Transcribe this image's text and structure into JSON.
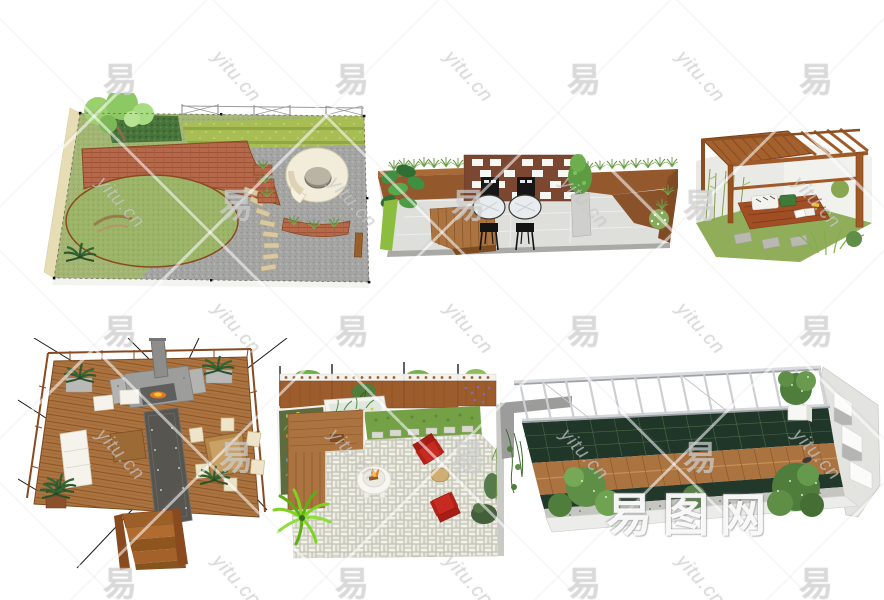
{
  "canvas": {
    "width": 884,
    "height": 600,
    "background": "#ffffff"
  },
  "watermark": {
    "glyph": "易",
    "script": "yitu.cn",
    "brand": "易图网",
    "glyph_grid": {
      "x_start": 120,
      "x_step": 116,
      "y_start": 77,
      "y_step": 126,
      "cols": 8,
      "rows": 5
    }
  },
  "renders": [
    {
      "id": "garden-plan-spiral-pavilion",
      "name": "garden plan with round lawn, terracotta paving and white spiral seat"
    },
    {
      "id": "linear-patio-brick-screen",
      "name": "long patio with brick screen wall, two black bistro chairs and glass tables"
    },
    {
      "id": "timber-pergola-daybed",
      "name": "wooden pergola over a slatted daybed with cushions and stepping stones"
    },
    {
      "id": "timber-deck-fireplace",
      "name": "large timber deck with stone fireplace, white lounge set and dining table"
    },
    {
      "id": "paver-courtyard-fire-table",
      "name": "basketweave paver courtyard with fire table, two red chairs and lattice fence"
    },
    {
      "id": "rooftop-terrace-steel-pergola",
      "name": "long rooftop terrace with steel pergola, green trellis band and wood boardwalk"
    }
  ],
  "palette": {
    "wood": "#aa7340",
    "wood_dark": "#8a5426",
    "terracotta": "#b5684a",
    "lawn": "#9cb468",
    "gravel": "#a3a3a3",
    "hedge": "#47743a",
    "steel_pergola": "#ced1d4",
    "trellis_green": "#1f3629",
    "chair_red": "#c62a20",
    "chair_black": "#161616",
    "cushion_cream": "#eee4c9",
    "paver_white": "#ecece2"
  }
}
